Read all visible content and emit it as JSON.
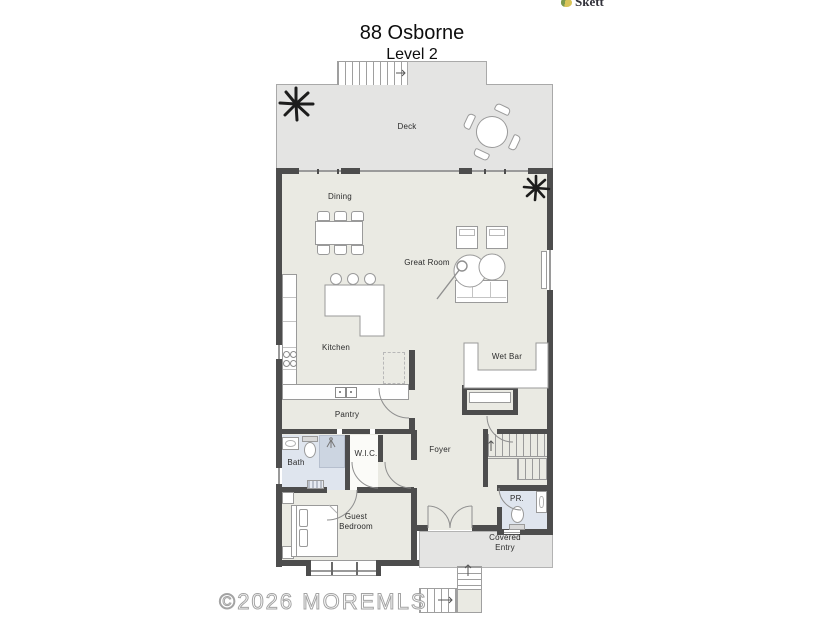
{
  "header": {
    "logo": "Skett",
    "title": "88 Osborne",
    "subtitle": "Level 2"
  },
  "rooms": {
    "deck": "Deck",
    "dining": "Dining",
    "great_room": "Great Room",
    "kitchen": "Kitchen",
    "wet_bar": "Wet Bar",
    "pantry": "Pantry",
    "bath": "Bath",
    "wic": "W.I.C.",
    "foyer": "Foyer",
    "guest_bedroom": "Guest Bedroom",
    "pr": "PR.",
    "covered_entry": "Covered Entry"
  },
  "watermark": "©2026 MOREMLS",
  "colors": {
    "wall": "#4d4d4d",
    "interior_floor": "#eaeae3",
    "deck_floor": "#e4e4e3",
    "bath_floor": "#dfe5ee",
    "shower_floor": "#ccd5e1",
    "furniture_stroke": "#9a9a9a"
  }
}
